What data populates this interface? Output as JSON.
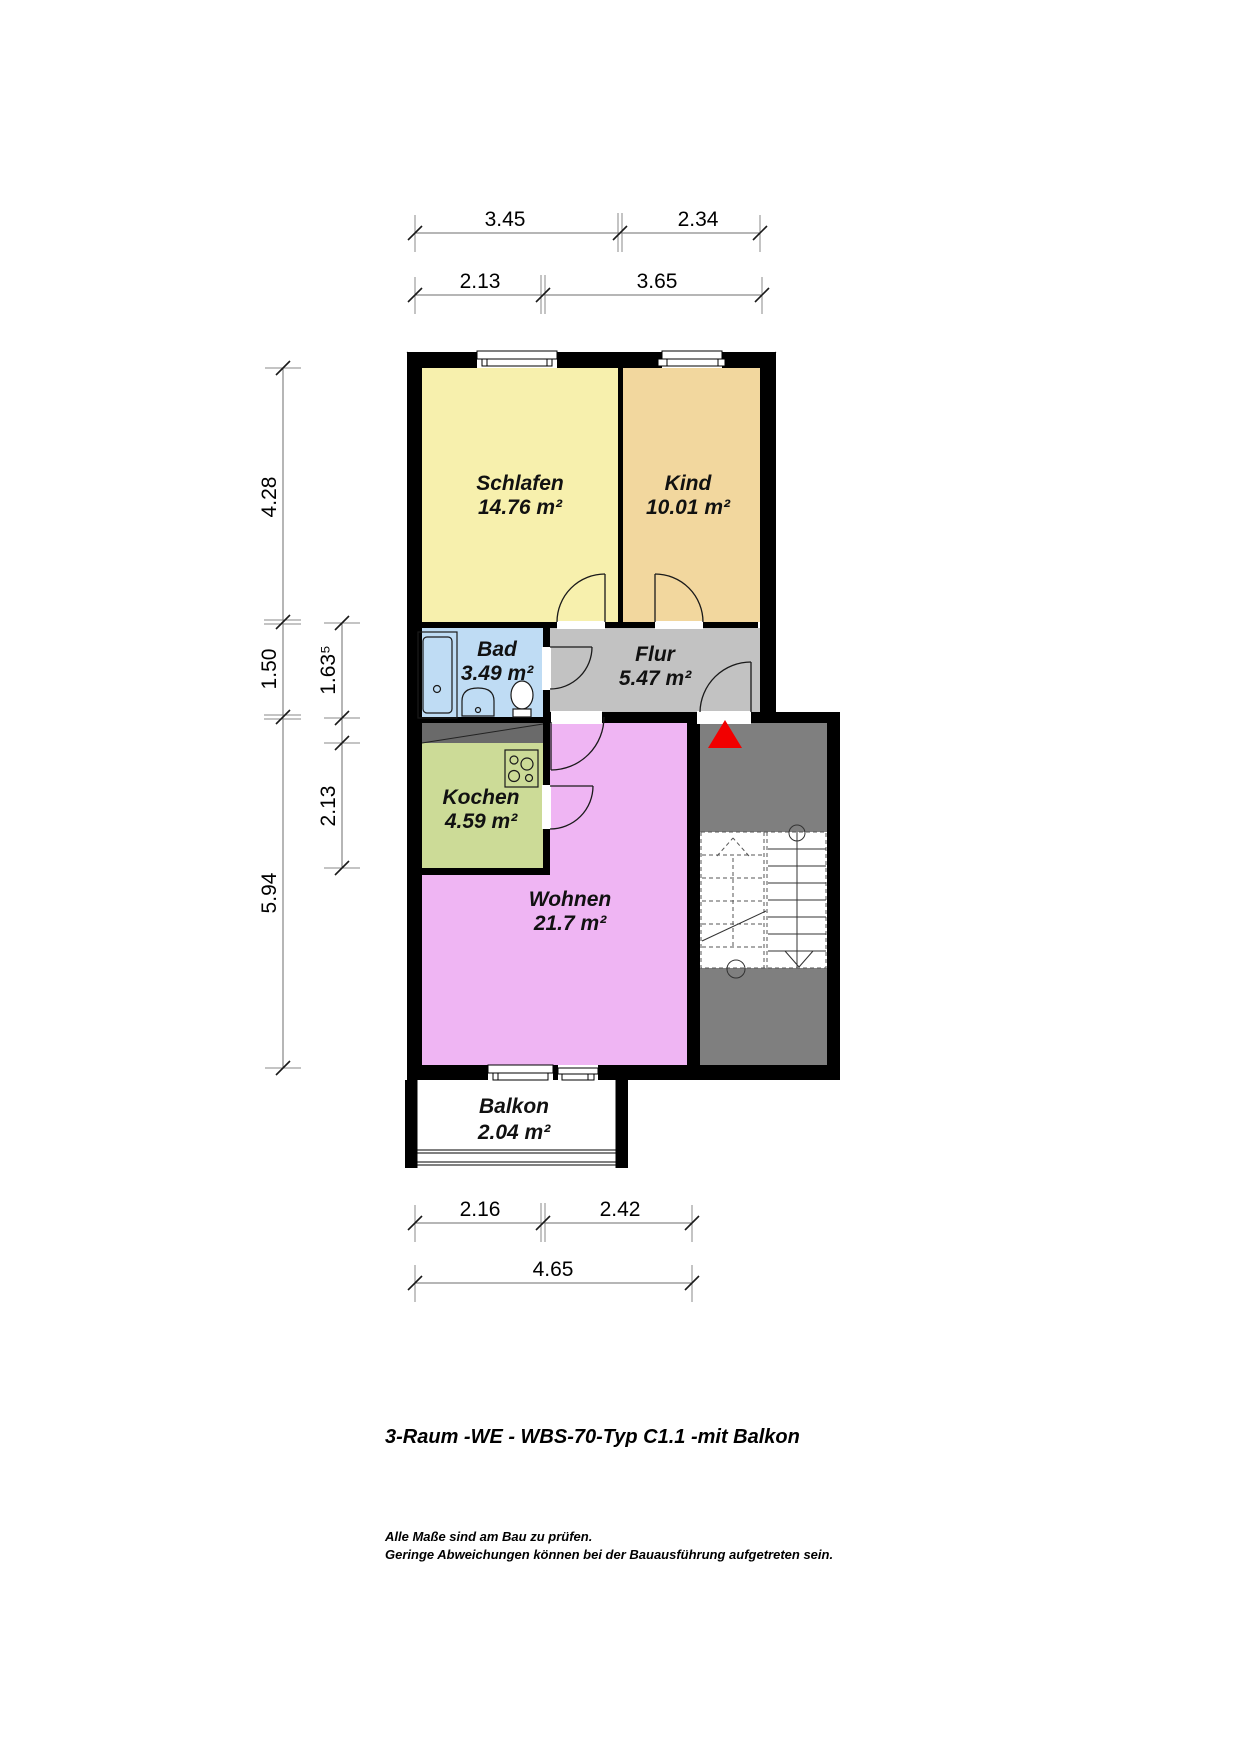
{
  "title": "3-Raum -WE - WBS-70-Typ C1.1 -mit Balkon",
  "notes": {
    "line1": "Alle Maße sind am Bau zu prüfen.",
    "line2": "Geringe Abweichungen können bei der Bauausführung aufgetreten sein."
  },
  "rooms": {
    "schlafen": {
      "name": "Schlafen",
      "area": "14.76 m²"
    },
    "kind": {
      "name": "Kind",
      "area": "10.01 m²"
    },
    "bad": {
      "name": "Bad",
      "area": "3.49 m²"
    },
    "flur": {
      "name": "Flur",
      "area": "5.47 m²"
    },
    "kochen": {
      "name": "Kochen",
      "area": "4.59 m²"
    },
    "wohnen": {
      "name": "Wohnen",
      "area": "21.7 m²"
    },
    "balkon": {
      "name": "Balkon",
      "area": "2.04 m²"
    }
  },
  "dims": {
    "top_row1": {
      "a": "3.45",
      "b": "2.34"
    },
    "top_row2": {
      "a": "2.13",
      "b": "3.65"
    },
    "left_outer": {
      "a": "4.28",
      "b": "1.50",
      "c": "5.94"
    },
    "left_inner": {
      "a": "1.63⁵",
      "b": "2.13"
    },
    "bottom_row1": {
      "a": "2.16",
      "b": "2.42"
    },
    "bottom_row2": {
      "a": "4.65"
    }
  },
  "colors": {
    "schlafen": "#F7F0AD",
    "kind": "#F2D79E",
    "bad": "#BFDCF4",
    "flur": "#C2C2C2",
    "kochen": "#CCDB97",
    "wohnen": "#EFB5F3",
    "stairwell": "#7F7F7F",
    "duct": "#6A6A6A",
    "wall": "#000000",
    "entrance_marker": "#F20000"
  }
}
